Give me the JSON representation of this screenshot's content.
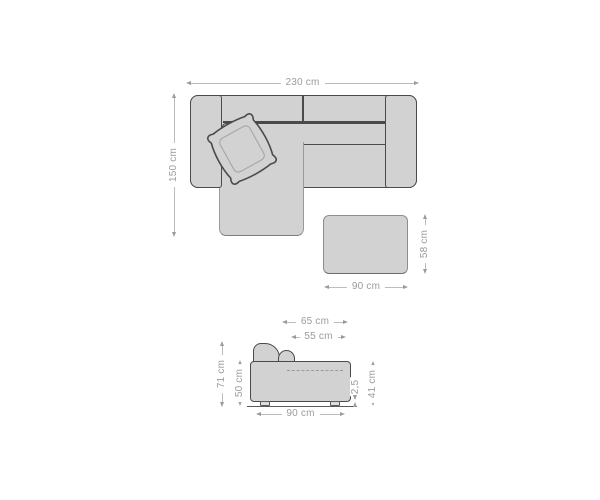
{
  "colors": {
    "background": "#ffffff",
    "furniture_fill": "#d2d2d2",
    "furniture_outline": "#4a4a4a",
    "soft_outline": "#9a9a9a",
    "dimension_line": "#bcbcbc",
    "dimension_text": "#9b9b9b"
  },
  "top_view": {
    "width_label": "230 cm",
    "depth_label": "150 cm"
  },
  "ottoman": {
    "width_label": "90 cm",
    "depth_label": "58 cm"
  },
  "side_view": {
    "back_depth_label": "65 cm",
    "seat_depth_label": "55 cm",
    "total_height_label": "71 cm",
    "armrest_height_label": "50 cm",
    "depth_label": "90 cm",
    "leg_height_label": "2,5",
    "seat_height_label": "41 cm"
  }
}
